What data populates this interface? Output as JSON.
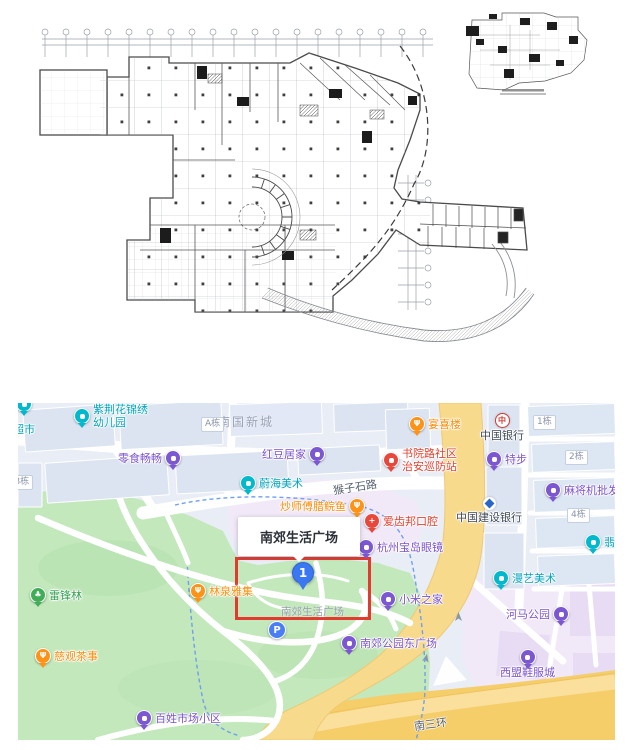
{
  "floorplan": {
    "description": "architectural CAD first-floor plan with key-plan inset, all annotation text illegible at this scale"
  },
  "map": {
    "area_label": "南国新城",
    "roads": {
      "houzishi": "猴子石路",
      "nansanhuan": "南三环"
    },
    "pills": {
      "a": "A栋",
      "b": "B栋",
      "n1": "1栋",
      "n2": "2栋",
      "n4": "4栋"
    },
    "popup": {
      "title": "南郊生活广场"
    },
    "marker_label": "1",
    "parking_label": "P",
    "ground_label": "南郊生活广场",
    "pois": {
      "chaoshi": {
        "label": "超市"
      },
      "kindergarten": {
        "line1": "紫荆花锦绣",
        "line2": "幼儿园"
      },
      "lingshi": {
        "label": "零食畅畅"
      },
      "hongdou": {
        "label": "红豆居家"
      },
      "weihai": {
        "label": "蔚海美术"
      },
      "yanxilou": {
        "label": "宴喜楼"
      },
      "shuyuan": {
        "line1": "书院路社区",
        "line2": "治安巡防站"
      },
      "tebu": {
        "label": "特步"
      },
      "boc": {
        "label": "中国银行"
      },
      "majiang": {
        "label": "麻将机批发"
      },
      "ccb": {
        "label": "中国建设银行"
      },
      "feicui": {
        "label": "翡翠"
      },
      "chaoshifu": {
        "label": "炒师傅腊鲩鱼"
      },
      "aichibang": {
        "label": "爱齿邦口腔"
      },
      "baodao": {
        "label": "杭州宝岛眼镜"
      },
      "xiaomi": {
        "label": "小米之家"
      },
      "manyi": {
        "label": "漫艺美术"
      },
      "hema": {
        "label": "河马公园"
      },
      "ximeng": {
        "label": "西盟鞋服城"
      },
      "dongguangchang": {
        "label": "南郊公园东广场"
      },
      "leifenglin": {
        "label": "雷锋林"
      },
      "linquan": {
        "label": "林泉雅集"
      },
      "ciguan": {
        "label": "慈观茶事"
      },
      "baixing": {
        "label": "百姓市场小区"
      }
    },
    "colors": {
      "teal": "#00b9cd",
      "purple": "#7b57d2",
      "orange": "#ff9318",
      "red": "#e8483c",
      "green": "#3fae57",
      "blue": "#3a77f2",
      "highlight_box": "#e23b2e",
      "park": "#c3e8bc",
      "highway": "#f5cd69",
      "plaza": "#f2e9f8"
    }
  }
}
